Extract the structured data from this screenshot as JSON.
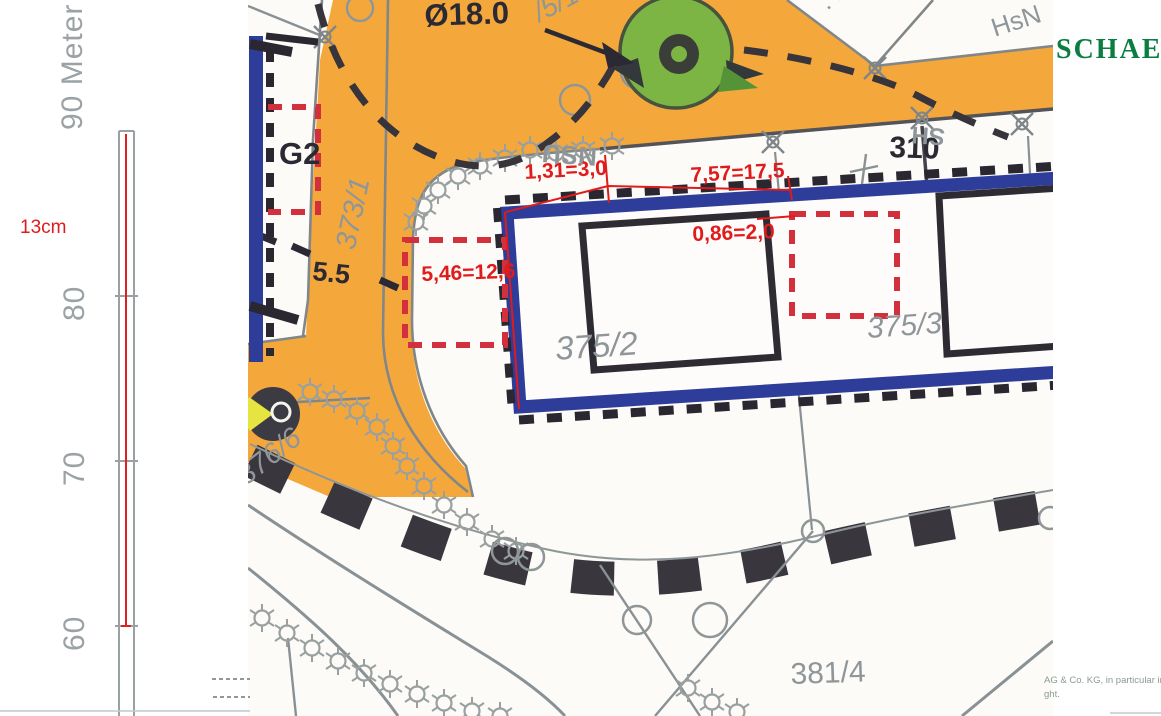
{
  "scale_bar": {
    "unit_label": "90 Meter",
    "tick_80": "80",
    "tick_70": "70",
    "tick_60": "60",
    "note": "13cm"
  },
  "map": {
    "labels": {
      "tree_diameter": "Ø18.0",
      "parcel_375_1": "/5/1",
      "house_number": ". 12",
      "house_abbr": "HsN",
      "garage": "G2",
      "parcel_373_1": "373/1",
      "fence_length": "5.5",
      "parcel_375_2": "375/2",
      "parcel_375_3": "375/3",
      "parcel_376_6": "376/6",
      "parcel_381_4": "381/4",
      "point_number": "310",
      "scan_text_a": "NSU",
      "scan_text_b": "SH"
    },
    "dimensions": {
      "top_left": "1,31=3,0",
      "top_right": "7,57=17,5",
      "offset": "0,86=2,0",
      "left": "5,46=12,6"
    }
  },
  "watermark": {
    "brand": "SCHAEFF",
    "copyright_line1": "AG & Co. KG, in particular in",
    "copyright_line2": "ght."
  },
  "colors": {
    "road_orange": "#f4a83c",
    "plan_blue": "#2e3d9a",
    "tree_green": "#7cb544",
    "dimension_red": "#e01b1b",
    "dashed_red": "#d2303c",
    "brand_green": "#0a7d41",
    "map_gray": "#8f9698"
  }
}
